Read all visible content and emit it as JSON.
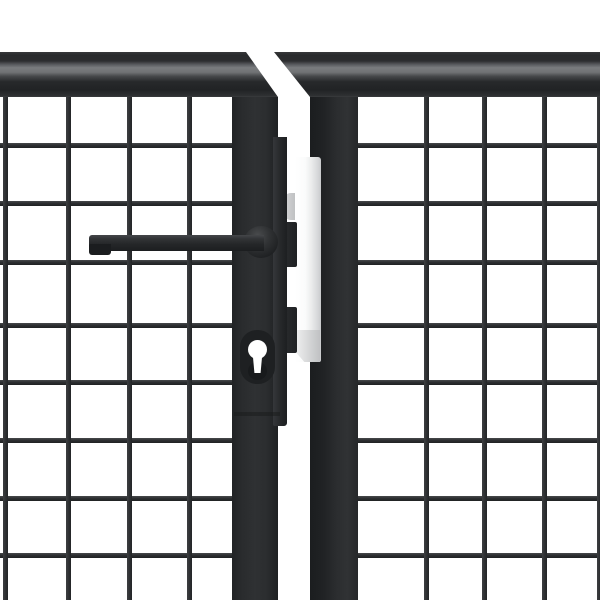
{
  "meta": {
    "alt": "Close-up product render of an anthracite grey steel mesh double garden gate on a white background, showing the two meeting stiles with door handle, euro-cylinder keyhole, dark latch cover strip and a stainless striker plate between the leaves",
    "product": "Anthracite steel mesh garden gate (double leaf), centre detail"
  },
  "palette": {
    "background": "#ffffff",
    "frame-dark": "#26282a",
    "frame-highlight": "#7a7c7e",
    "mesh-wire": "#2e3032",
    "mesh-wire-highlight": "#47494b",
    "handle-dark": "#212325",
    "plate-light": "#ffffff",
    "plate-dark": "#c8c9cb",
    "escutcheon": "#1e2022",
    "keyhole-cutout": "#ffffff"
  },
  "geometry": {
    "stage": {
      "width": 600,
      "height": 600
    },
    "boxes": {
      "meshL": {
        "x": 0,
        "y": 97,
        "w": 236,
        "h": 503
      },
      "meshR": {
        "x": 354,
        "y": 97,
        "w": 246,
        "h": 503
      },
      "postL": {
        "x": 232,
        "y": 97,
        "w": 46,
        "h": 503
      },
      "postR": {
        "x": 310,
        "y": 97,
        "w": 48,
        "h": 503
      },
      "frameL": {
        "x": 0,
        "y": 52,
        "w": 278,
        "h": 45
      },
      "frameR": {
        "x": 274,
        "y": 52,
        "w": 326,
        "h": 45
      },
      "grayTab": {
        "x": 283,
        "y": 193,
        "w": 14,
        "h": 27
      },
      "plate": {
        "x": 295,
        "y": 157,
        "w": 26,
        "h": 205
      },
      "plateFoot": {
        "x": 297,
        "y": 330,
        "w": 23,
        "h": 32
      },
      "keeper1": {
        "x": 282,
        "y": 222,
        "w": 15,
        "h": 45
      },
      "keeper2": {
        "x": 282,
        "y": 307,
        "w": 15,
        "h": 46
      },
      "strip": {
        "x": 273,
        "y": 137,
        "w": 14,
        "h": 289
      },
      "lockStep": {
        "x": 234,
        "y": 412,
        "w": 46,
        "h": 4
      },
      "boss": {
        "x": 244,
        "y": 226,
        "w": 34,
        "h": 32
      },
      "bar": {
        "x": 89,
        "y": 235,
        "w": 175,
        "h": 16
      },
      "barStep": {
        "x": 89,
        "y": 244,
        "w": 22,
        "h": 11
      },
      "esc": {
        "x": 240,
        "y": 330,
        "w": 35,
        "h": 54
      },
      "escShadow": {
        "x": 248,
        "y": 362,
        "w": 19,
        "h": 18
      },
      "keyC": {
        "x": 248,
        "y": 340,
        "w": 19,
        "h": 19
      },
      "keyS": {
        "x": 252,
        "y": 356,
        "w": 11,
        "h": 17
      }
    },
    "mesh": {
      "wire_thickness": 5,
      "horizontal_y": [
        143,
        201,
        260,
        323,
        380,
        438,
        496,
        553
      ],
      "left_vertical_x": [
        3,
        66,
        127,
        187
      ],
      "right_vertical_x": [
        424,
        482,
        542,
        597
      ]
    }
  }
}
